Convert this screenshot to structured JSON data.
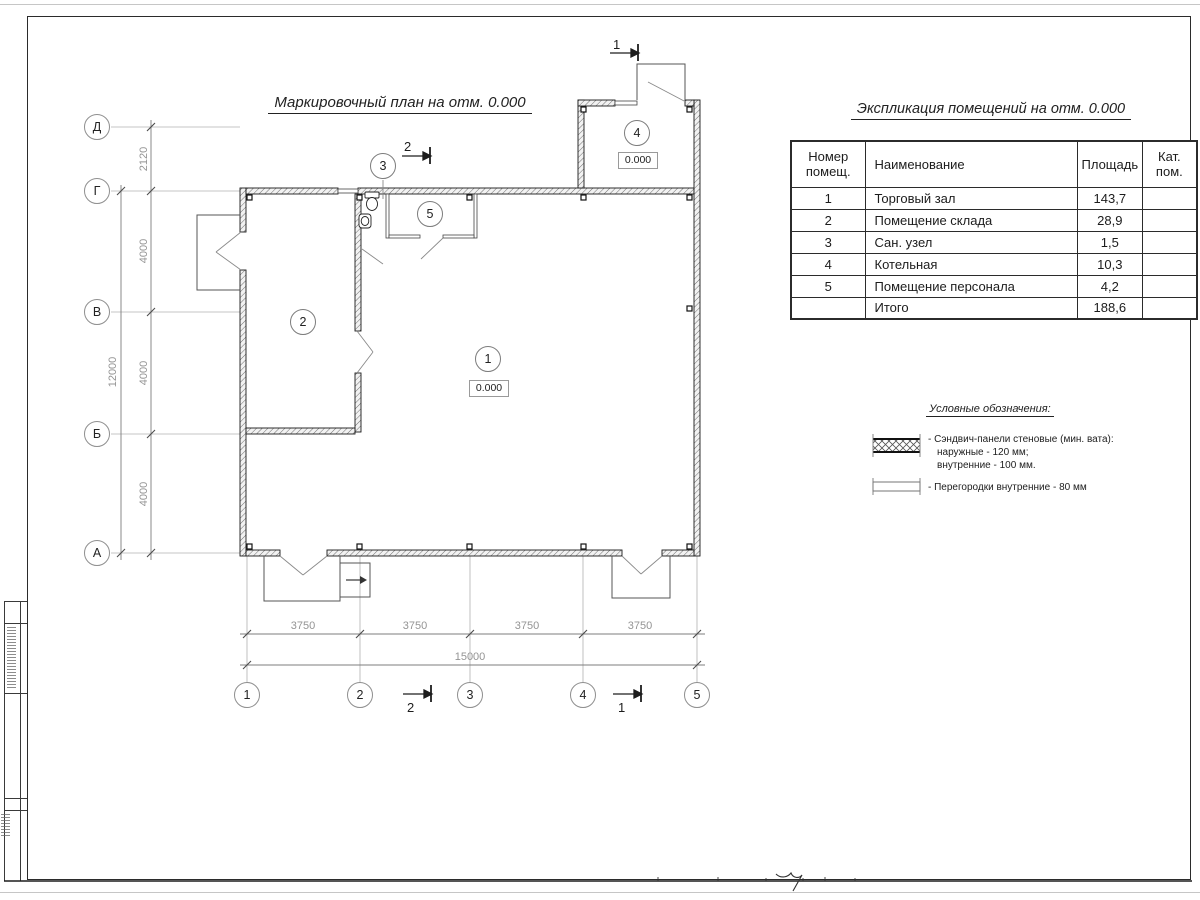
{
  "plan": {
    "title": "Маркировочный план на отм. 0.000",
    "axes_left": [
      "Д",
      "Г",
      "В",
      "Б",
      "А"
    ],
    "axes_bottom": [
      "1",
      "2",
      "3",
      "4",
      "5"
    ],
    "dims_left": [
      "2120",
      "4000",
      "4000",
      "4000"
    ],
    "dims_left_total": "12000",
    "dims_bottom": [
      "3750",
      "3750",
      "3750",
      "3750"
    ],
    "dims_bottom_total": "15000",
    "section_marks": {
      "mark1": "1",
      "mark2": "2"
    },
    "rooms": [
      {
        "number": "1",
        "name": "Торговый зал",
        "elevation": "0.000"
      },
      {
        "number": "2",
        "name": "Помещение склада"
      },
      {
        "number": "3",
        "name": "Сан. узел"
      },
      {
        "number": "4",
        "name": "Котельная",
        "elevation": "0.000"
      },
      {
        "number": "5",
        "name": "Помещение персонала"
      }
    ]
  },
  "schedule": {
    "title": "Экспликация помещений на отм. 0.000",
    "headers": {
      "number": "Номер помещ.",
      "name": "Наименование",
      "area": "Площадь",
      "category": "Кат. пом."
    },
    "rows": [
      {
        "number": "1",
        "name": "Торговый зал",
        "area": "143,7",
        "category": ""
      },
      {
        "number": "2",
        "name": "Помещение склада",
        "area": "28,9",
        "category": ""
      },
      {
        "number": "3",
        "name": "Сан. узел",
        "area": "1,5",
        "category": ""
      },
      {
        "number": "4",
        "name": "Котельная",
        "area": "10,3",
        "category": ""
      },
      {
        "number": "5",
        "name": "Помещение персонала",
        "area": "4,2",
        "category": ""
      }
    ],
    "total": {
      "label": "Итого",
      "area": "188,6",
      "category": ""
    }
  },
  "legend": {
    "title": "Условные обозначения:",
    "item1_line1": "- Сэндвич-панели стеновые (мин. вата):",
    "item1_line2": "наружные - 120 мм;",
    "item1_line3": "внутренние - 100 мм.",
    "item2_line1": "- Перегородки внутренние - 80 мм"
  },
  "colors": {
    "line": "#2b2b2b",
    "dim_text": "#949494",
    "paper": "#ffffff"
  }
}
